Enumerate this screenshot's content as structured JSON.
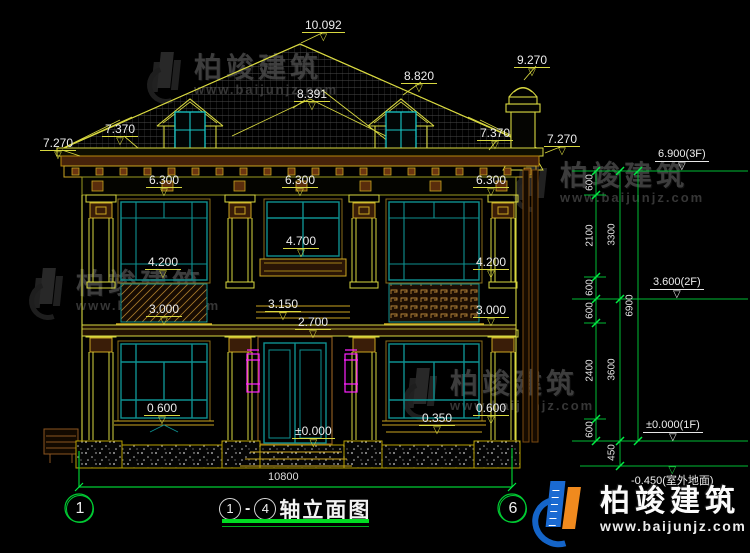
{
  "watermark": {
    "brand": "柏竣建筑",
    "url": "www.baijunjz.com"
  },
  "logo": {
    "brand": "柏竣建筑",
    "url": "www.baijunjz.com"
  },
  "title": {
    "axis_start": "1",
    "separator": "-",
    "axis_end": "4",
    "label": "轴立面图"
  },
  "axes": {
    "left_bubble": "1",
    "right_bubble": "6"
  },
  "overall_width": "10800",
  "elevations": {
    "roof_peak": "10.092",
    "chimney_top": "9.270",
    "dormer_ridge": "8.820",
    "roof_mid_ridge": "8.391",
    "eave_left_outer": "7.270",
    "eave_left_inner": "7.370",
    "eave_right_inner": "7.370",
    "eave_right_outer": "7.270",
    "cornice_left": "6.300",
    "cornice_center": "6.300",
    "cornice_right": "6.300",
    "window2f_left_head": "4.200",
    "balcony_center": "4.700",
    "window2f_right_head": "4.200",
    "spandrel_left": "3.000",
    "belt_center": "3.150",
    "door_head": "2.700",
    "spandrel_right": "3.000",
    "sill1f_left": "0.600",
    "sill1f_right_low": "0.350",
    "sill1f_right": "0.600",
    "floor_zero": "±0.000"
  },
  "floor_levels": {
    "f3": "6.900(3F)",
    "f2": "3.600(2F)",
    "f1": "±0.000(1F)",
    "ground": "-0.450(室外地面)"
  },
  "dim_chains": {
    "inner": [
      "600",
      "2100",
      "600",
      "600",
      "2400",
      "600"
    ],
    "middle": [
      "3300",
      "3600",
      "450"
    ],
    "outer": [
      "6900"
    ]
  }
}
